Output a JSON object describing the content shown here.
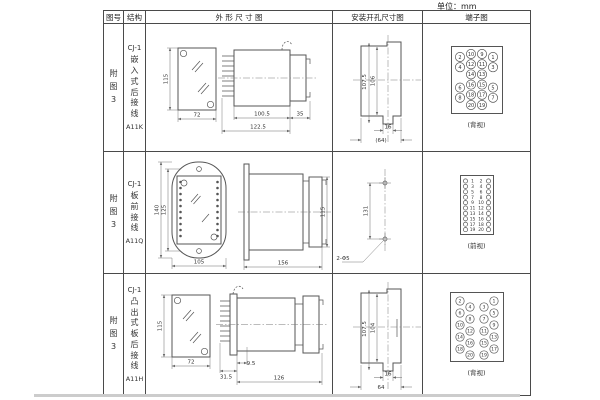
{
  "unit_label": "单位：mm",
  "table_header": {
    "fig": "图号",
    "struct": "结构",
    "outline": "外 形 尺 寸 图",
    "install": "安装开孔尺寸图",
    "terminal": "端子图"
  },
  "rows": [
    {
      "fig_no": "附图3",
      "model": "CJ-1",
      "mounting": "嵌入式后接线",
      "code": "A11K",
      "outline": {
        "front_h": "115",
        "front_w": "72",
        "d1": "100.5",
        "d2": "122.5",
        "d3": "35"
      },
      "install": {
        "v1": "107.5",
        "v2": "106",
        "slot": "16",
        "width": "(64)"
      },
      "terminal": {
        "layout": "grid4",
        "view_label": "(背视)",
        "rows": [
          [
            2,
            10,
            9,
            1
          ],
          [
            4,
            12,
            11,
            3
          ],
          [
            null,
            14,
            13,
            null
          ],
          [
            6,
            16,
            15,
            5
          ],
          [
            8,
            18,
            17,
            7
          ],
          [
            null,
            20,
            19,
            null
          ]
        ]
      }
    },
    {
      "fig_no": "附图3",
      "model": "CJ-1",
      "mounting": "板前接线",
      "code": "A11Q",
      "outline": {
        "front_h1": "140",
        "front_h2": "125",
        "front_w": "105",
        "side_l": "156",
        "side_h": "115"
      },
      "install": {
        "v1": "131",
        "hole_label": "2-Φ5"
      },
      "terminal": {
        "layout": "pairs",
        "view_label": "(前视)",
        "pairs": [
          [
            1,
            2
          ],
          [
            3,
            4
          ],
          [
            5,
            6
          ],
          [
            7,
            8
          ],
          [
            9,
            10
          ],
          [
            11,
            12
          ],
          [
            13,
            14
          ],
          [
            15,
            16
          ],
          [
            17,
            18
          ],
          [
            19,
            20
          ]
        ]
      }
    },
    {
      "fig_no": "附图3",
      "model": "CJ-1",
      "mounting": "凸出式板后接线",
      "code": "A11H",
      "outline": {
        "front_h": "115",
        "front_w": "72",
        "d1": "31.5",
        "d2": "9.5",
        "d3": "126"
      },
      "install": {
        "v1": "107.5",
        "v2": "104",
        "slot": "16",
        "width": "64"
      },
      "terminal": {
        "layout": "zigzag",
        "view_label": "(背视)",
        "left_outer": [
          2,
          6,
          10,
          14,
          18
        ],
        "left_inner": [
          4,
          8,
          12,
          16,
          20
        ],
        "right_inner": [
          3,
          7,
          11,
          15,
          19
        ],
        "right_outer": [
          1,
          5,
          9,
          13,
          17
        ]
      }
    }
  ]
}
